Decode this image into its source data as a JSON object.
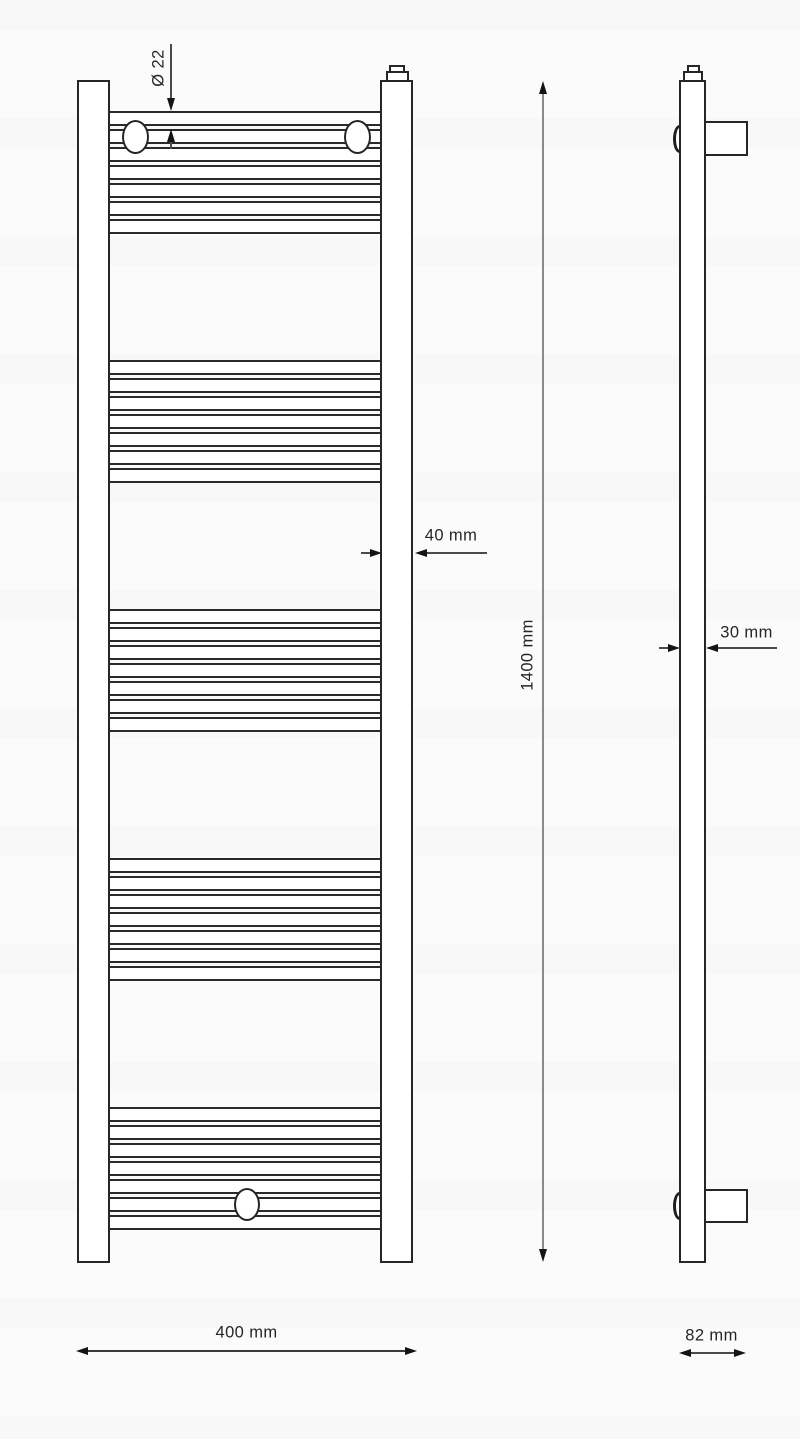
{
  "drawing_title": "Ladder towel radiator - dimensional drawing, front and side view",
  "dimensions": {
    "tube_diameter": {
      "label": "Ø 22",
      "orientation": "vertical",
      "measures": "rung tube diameter"
    },
    "collector_width": {
      "label": "40 mm",
      "orientation": "horizontal",
      "measures": "vertical collector width"
    },
    "total_height": {
      "label": "1400 mm",
      "orientation": "vertical",
      "measures": "overall height"
    },
    "profile_depth": {
      "label": "30 mm",
      "orientation": "horizontal",
      "measures": "profile thickness (side view)"
    },
    "total_width": {
      "label": "400 mm",
      "orientation": "horizontal",
      "measures": "overall width"
    },
    "wall_depth": {
      "label": "82 mm",
      "orientation": "horizontal",
      "measures": "depth including wall bracket"
    }
  },
  "front_view": {
    "tube_group_count": 5,
    "tubes_per_group": 7,
    "wall_plug_count": 2,
    "bottom_valve_count": 1,
    "tubes": {
      "x": 108,
      "w": 276,
      "tube_h": 15,
      "gap": 3,
      "groups": [
        {
          "top": 111
        },
        {
          "top": 360
        },
        {
          "top": 609
        },
        {
          "top": 858
        },
        {
          "top": 1107
        }
      ]
    }
  },
  "side_view": {
    "wall_bracket_count": 2
  },
  "colors": {
    "line": "#262626",
    "dim_line": "#4a4a4a",
    "dim_line_light": "#8a8a8a",
    "arrow": "#141414",
    "text": "#252525",
    "background": "#fbfbfb"
  }
}
